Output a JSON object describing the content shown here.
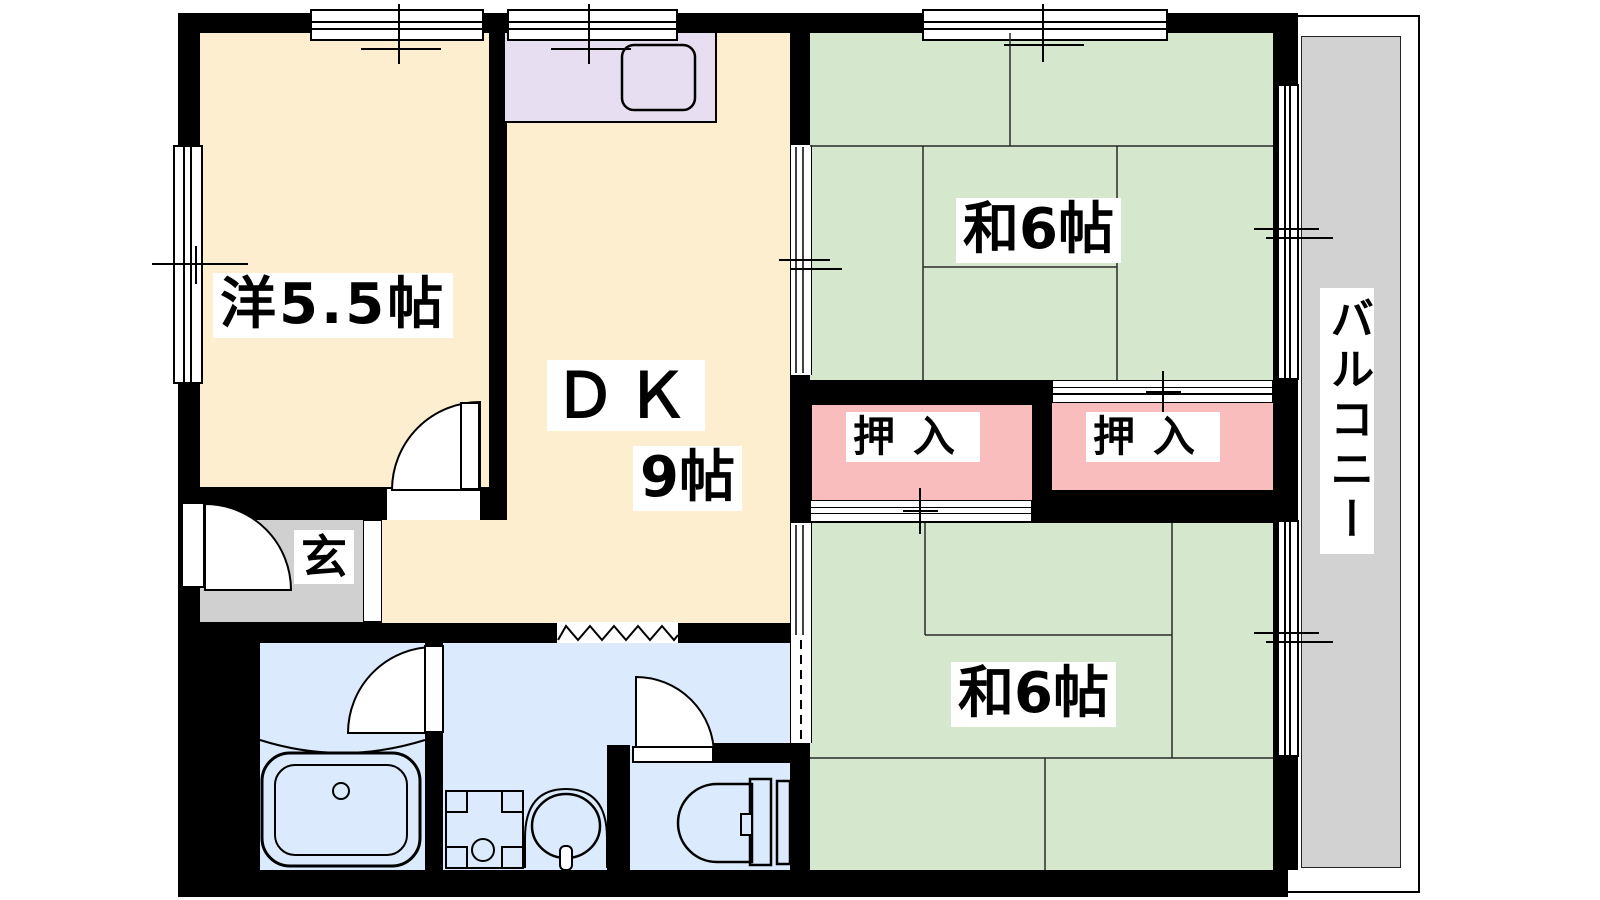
{
  "floorplan": {
    "rooms": {
      "western": {
        "label": "洋5.5帖"
      },
      "dk": {
        "label": "ＤＫ",
        "size": "9帖"
      },
      "tatami_north": {
        "label": "和6帖"
      },
      "tatami_south": {
        "label": "和6帖"
      },
      "closet_west": {
        "label": "押入"
      },
      "closet_east": {
        "label": "押入"
      },
      "entrance": {
        "label": "玄"
      },
      "balcony": {
        "label": "バルコニー"
      }
    },
    "fixtures": [
      "kitchen-sink",
      "bathtub",
      "wash-basin",
      "washing-machine-pan",
      "toilet",
      "accordion-door",
      "hinged-doors",
      "sliding-doors",
      "windows"
    ],
    "colors": {
      "wall": "#000000",
      "wood_floor": "#fdeed0",
      "tatami": "#d5e7cd",
      "closet": "#fabdbd",
      "kitchen_counter": "#e7def1",
      "bathroom": "#dbeafc",
      "entrance_floor": "#d0d0d0",
      "balcony_floor": "#d2d2d2"
    }
  }
}
